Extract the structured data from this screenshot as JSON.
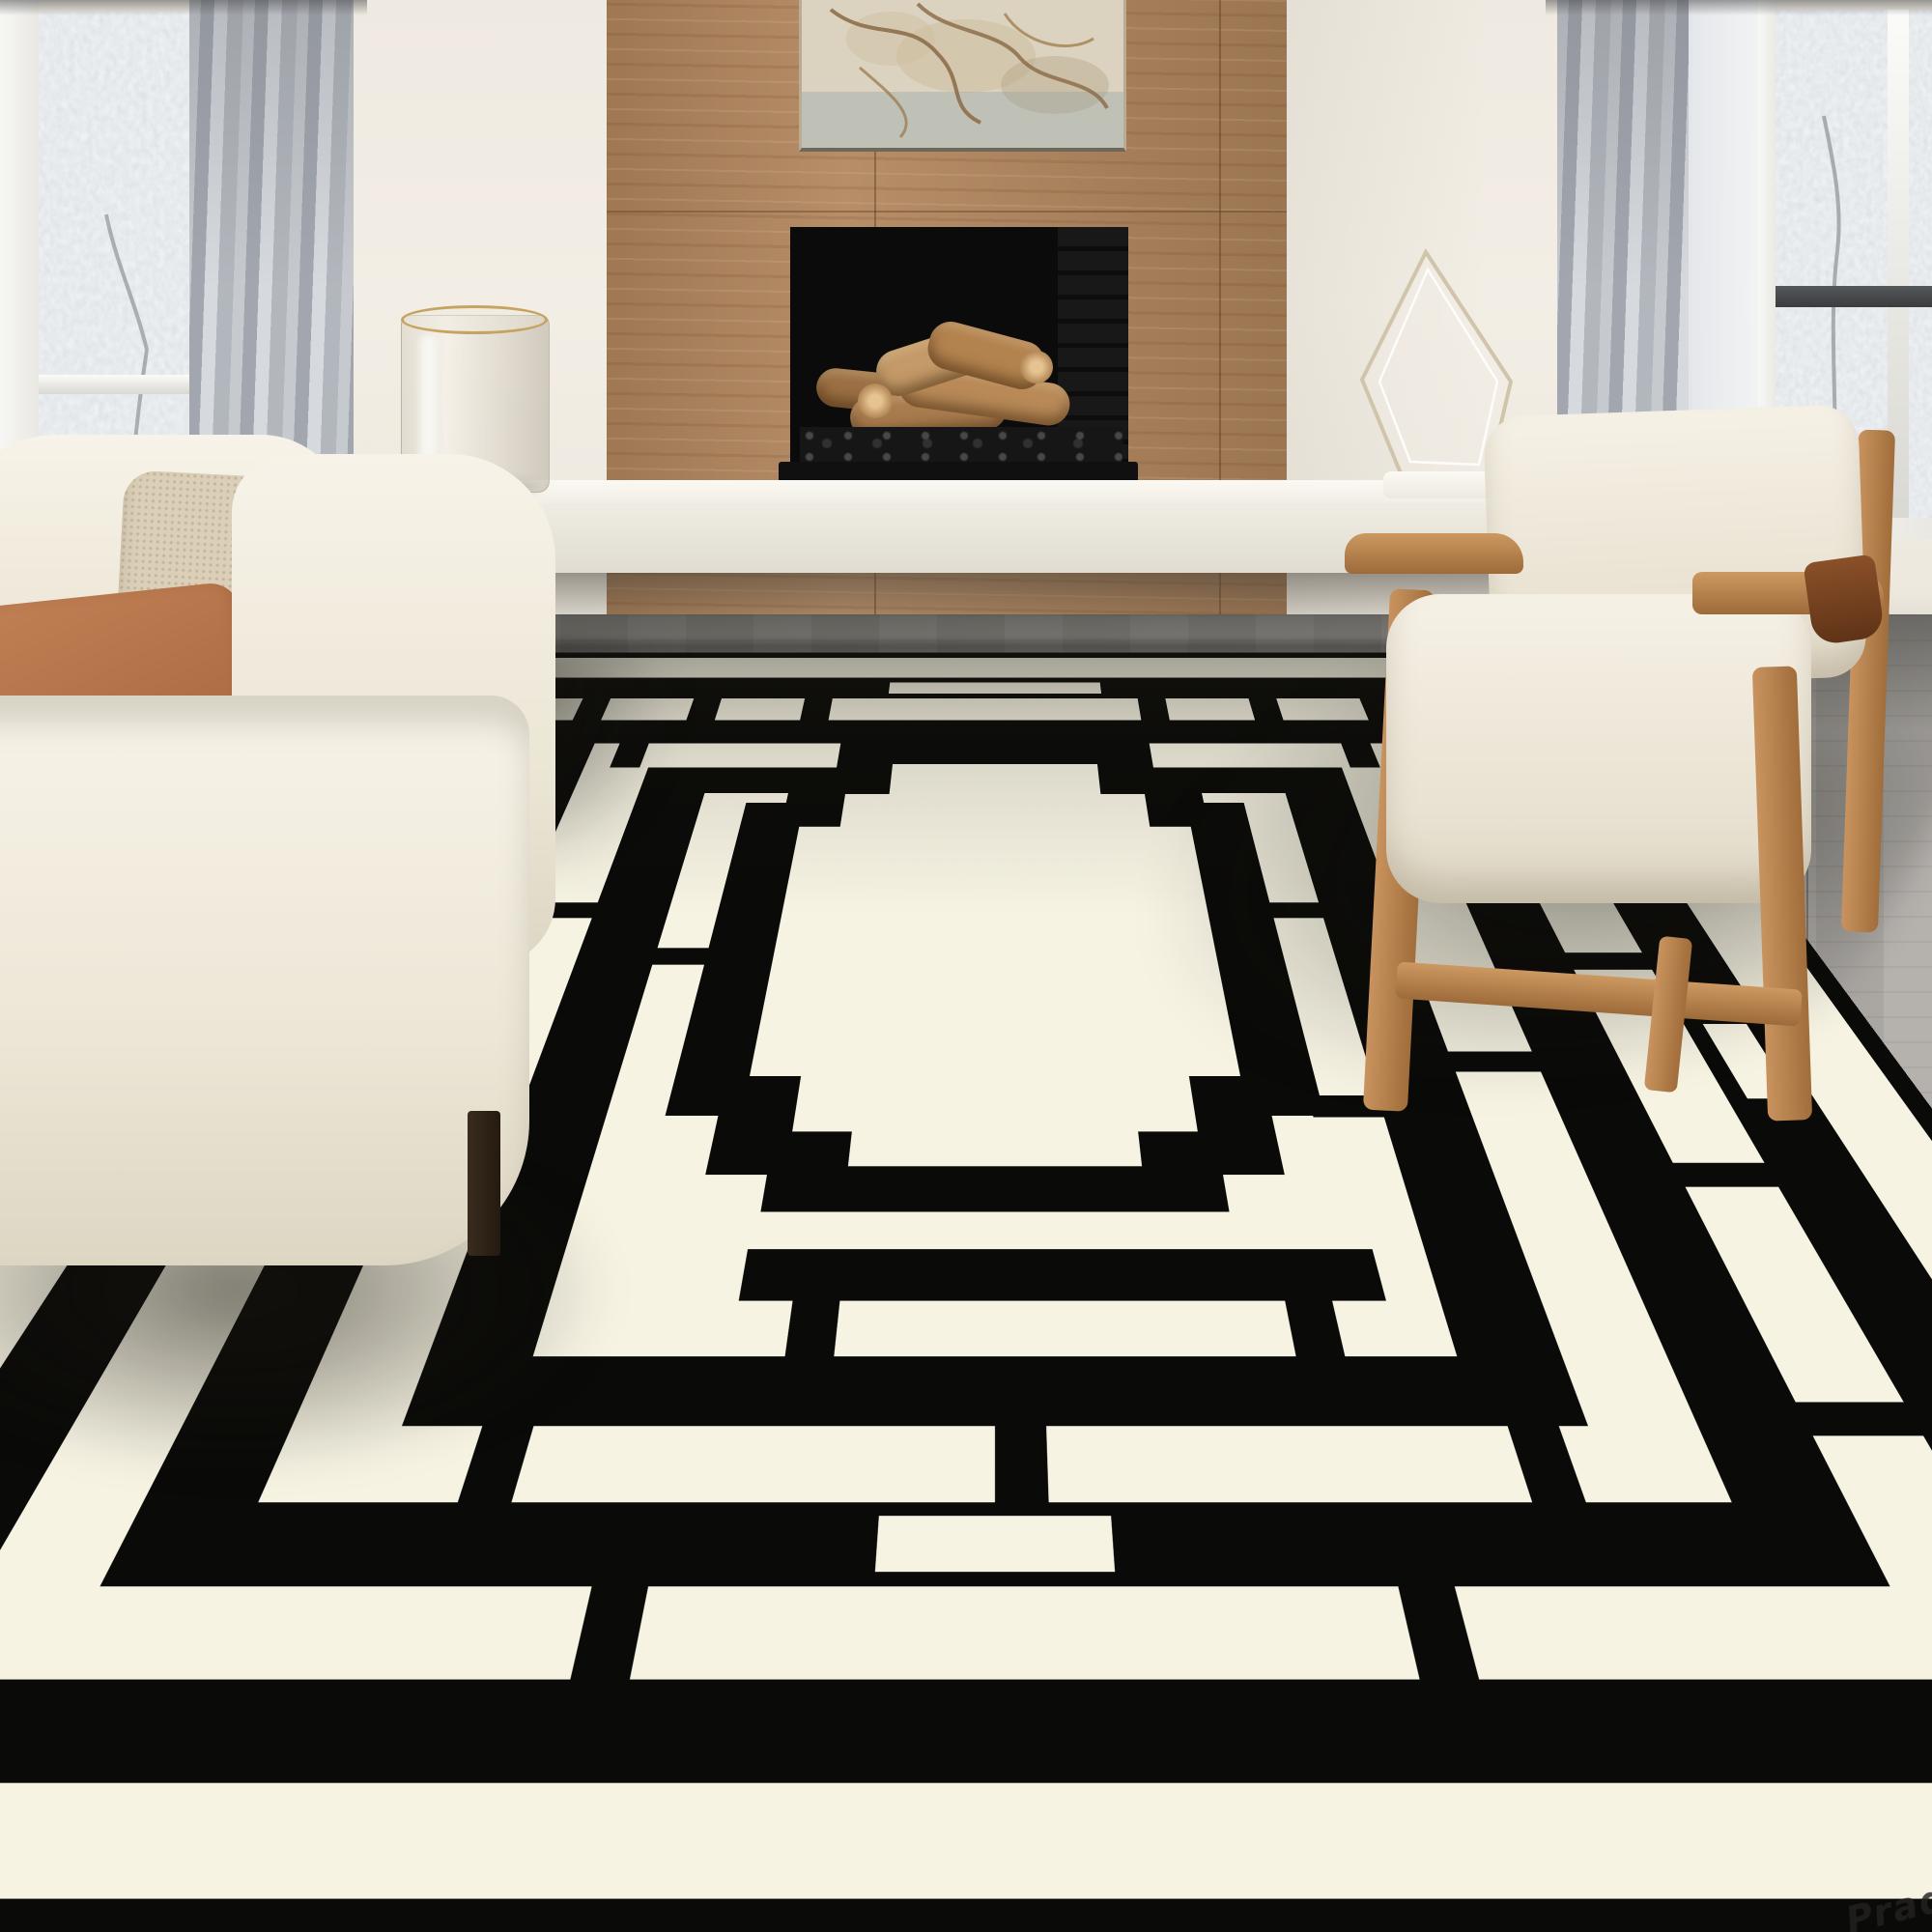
{
  "scene": {
    "type": "interior product photograph",
    "subject": "black and cream geometric maze-pattern area rug in a modern living room",
    "room_features": [
      "left window with gray curtains",
      "cream sofa with rust and beige pillows",
      "glass hurricane vase with gold rim",
      "wood-panel fireplace with black firebox and stacked logs",
      "abstract marble artwork above fireplace",
      "white floating bench hearth",
      "glass diamond sculpture",
      "mid-century cream armchair with wood frame",
      "right window with gray curtain and sheer",
      "gray wood plank floor"
    ]
  },
  "watermark": {
    "text": "Prad"
  },
  "palette": {
    "rug_black": "#0a0a08",
    "rug_cream": "#f6f3e3",
    "wall": "#f1ece3",
    "fireplace_wood": "#b1855c",
    "floor_gray": "#a8a5a0",
    "sofa_cream": "#f0ebdf",
    "pillow_rust": "#b0714a",
    "pillow_beige": "#dbcfb8",
    "chair_wood": "#bb8a57",
    "curtain_gray": "#b6bac1",
    "bench_white": "#f4f1ea",
    "firebox_black": "#0b0b0b",
    "log_tan": "#b98a58",
    "vase_gold_rim": "#c6a360"
  }
}
